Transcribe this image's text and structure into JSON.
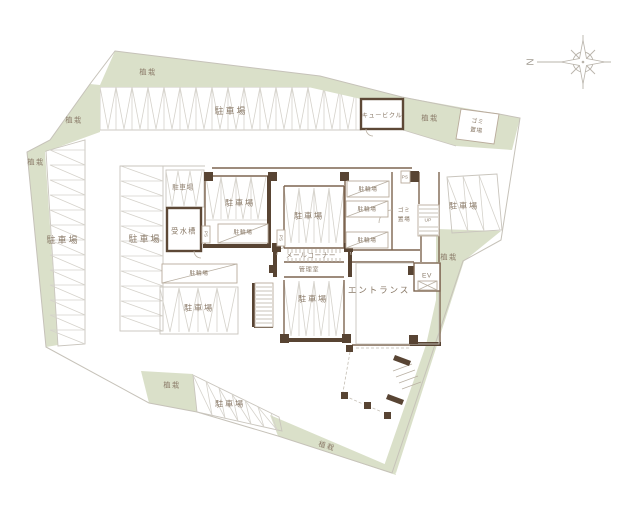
{
  "labels": {
    "planting": "植栽",
    "parking": "駐車場",
    "bicycle_parking": "駐輪場",
    "cubicle": "キュービクル",
    "garbage_line1": "ゴミ",
    "garbage_line2": "置場",
    "water_tank": "受水槽",
    "mail_corner": "メールコーナー",
    "manager_room": "管理室",
    "entrance": "エントランス",
    "elevator": "EV",
    "up": "UP",
    "pipe_space": "PS",
    "north": "N"
  },
  "colors": {
    "planting_green": "#dae0c9",
    "wall_dark_brown": "#584433",
    "wall_medium_brown": "#7d6550",
    "label_brown": "#8a7a68",
    "line_gray": "#c6c2b9",
    "stall_gray": "#d5d2cb"
  }
}
